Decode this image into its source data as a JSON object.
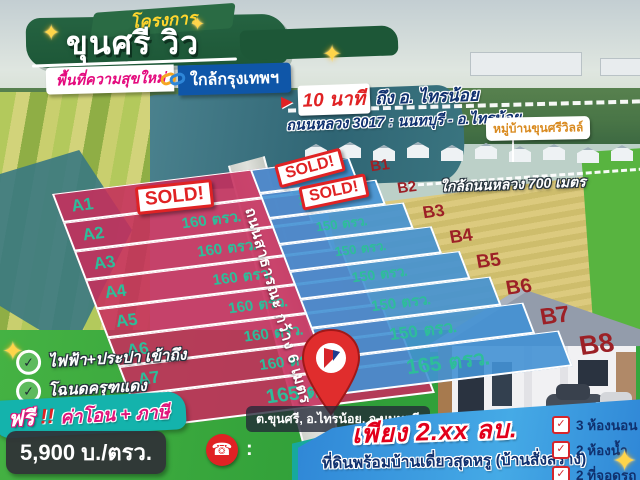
{
  "header": {
    "ribbon": "โครงการ",
    "title": "ขุนศรี วิว",
    "subtitle_left": "พื้นที่ความสุขใหม่",
    "subtitle_right": "ใกล้กรุงเทพฯ"
  },
  "top_right": {
    "arrow": "▶",
    "time_highlight": "10 นาที",
    "time_rest": "ถึง อ. ไทรน้อย",
    "road_line": "ถนนหลวง 3017 : นนทบุรี - อ.ไทรน้อย",
    "village_label": "หมู่บ้านขุนศรีวิลล์",
    "near_road": "ใกล้ถนนหลวง 700 เมตร"
  },
  "plots": {
    "road_label": "ถนนสาธารณะ กว้าง 6 เมตร",
    "sold_label": "SOLD!",
    "section_a": [
      {
        "id": "A1",
        "size": ""
      },
      {
        "id": "A2",
        "size": "160 ตรว."
      },
      {
        "id": "A3",
        "size": "160 ตรว."
      },
      {
        "id": "A4",
        "size": "160 ตรว."
      },
      {
        "id": "A5",
        "size": "160 ตรว."
      },
      {
        "id": "A6",
        "size": "160 ตรว."
      },
      {
        "id": "A7",
        "size": "160 ตรว."
      },
      {
        "id": "A8",
        "size": "165 ตรว."
      }
    ],
    "section_b": [
      {
        "id": "B1",
        "size": "248 ตรว."
      },
      {
        "id": "B2",
        "size": "200 ตรว."
      },
      {
        "id": "B3",
        "size": "150 ตรว."
      },
      {
        "id": "B4",
        "size": "150 ตรว."
      },
      {
        "id": "B5",
        "size": "150 ตรว."
      },
      {
        "id": "B6",
        "size": "150 ตรว."
      },
      {
        "id": "B7",
        "size": "150 ตรว."
      },
      {
        "id": "B8",
        "size": "165 ตรว."
      }
    ]
  },
  "location": {
    "pin_text": "ต.ขุนศรี, อ.ไทรน้อย, จ.นนทบุรี"
  },
  "features": {
    "check": "✓",
    "item1": "ไฟฟ้า+ประปา เข้าถึง",
    "item2": "โฉนดครุฑแดง"
  },
  "promo": {
    "free_word": "ฟรี",
    "free_bang": "!!",
    "free_items": "ค่าโอน + ภาษี"
  },
  "price": {
    "per_sqw": "5,900 บ./ตรว.",
    "colon": ":"
  },
  "offer": {
    "price_line": "เพียง 2.xx ลบ.",
    "desc_line": "ที่ดินพร้อมบ้านเดี่ยวสุดหรู (บ้านสั่งสร้าง)",
    "house_features": [
      "3 ห้องนอน",
      "2 ห้องน้ำ",
      "2 ที่จอดรถ"
    ]
  },
  "colors": {
    "plot_a": "#c62d5c",
    "plot_b": "#4291d4",
    "plot_text": "#2ebd9a",
    "sold_red": "#e02224",
    "banner_green": "#215c39",
    "subtitle_blue": "#0f56a8",
    "magenta": "#e40a7e",
    "navy": "#10316f",
    "teal_banner": "#14b3ac",
    "band_blue": "#2f86d6"
  }
}
